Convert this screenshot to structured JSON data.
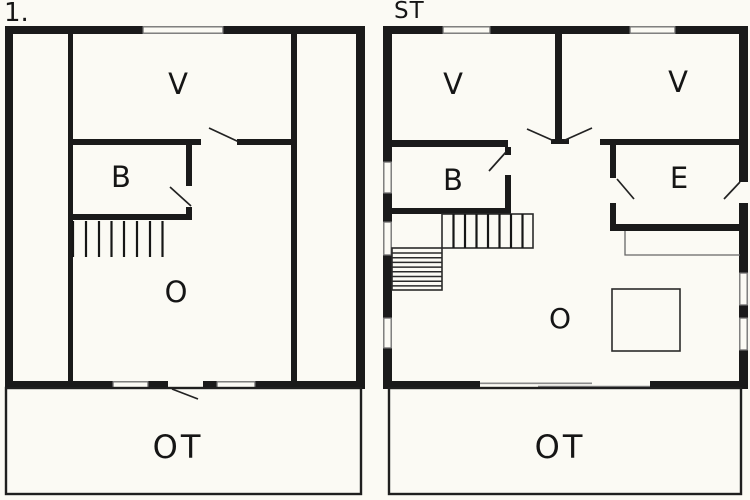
{
  "palette": {
    "background": "#fbfaf4",
    "wall": "#1a1a1a",
    "window_line": "#6b6b6b",
    "thin_line": "#2a2a2a"
  },
  "plans": [
    {
      "title": "1.",
      "rooms": [
        {
          "label": "V"
        },
        {
          "label": "B"
        },
        {
          "label": "O"
        },
        {
          "label": "OT"
        }
      ]
    },
    {
      "title": "ST",
      "rooms": [
        {
          "label": "V"
        },
        {
          "label": "V"
        },
        {
          "label": "B"
        },
        {
          "label": "E"
        },
        {
          "label": "O"
        },
        {
          "label": "OT"
        }
      ]
    }
  ]
}
